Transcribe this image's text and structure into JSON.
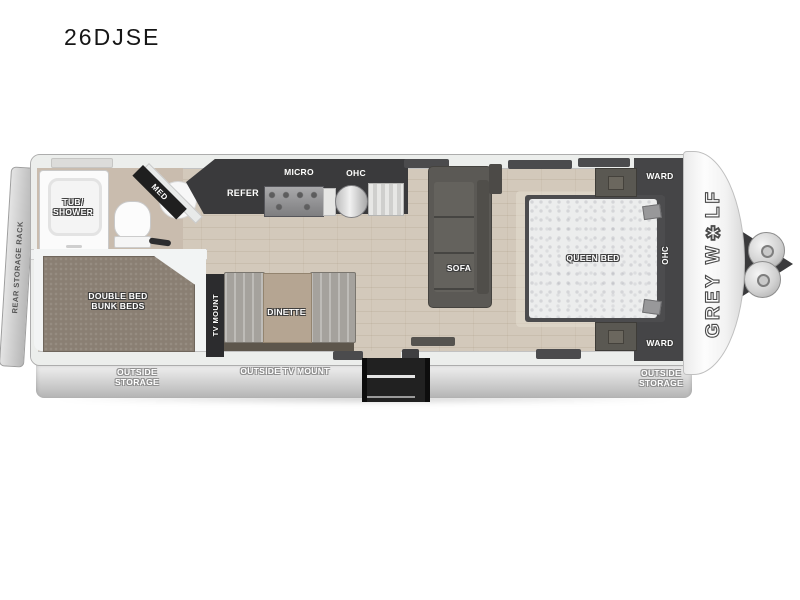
{
  "title": "26DJSE",
  "brand_logo": "GREY W✱LF",
  "exterior_labels": {
    "rear_storage_rack": "REAR STORAGE RACK",
    "outside_storage_left_line1": "OUTSIDE",
    "outside_storage_left_line2": "STORAGE",
    "outside_tv_mount": "OUTSIDE TV MOUNT",
    "outside_storage_right_line1": "OUTSIDE",
    "outside_storage_right_line2": "STORAGE"
  },
  "bathroom": {
    "tub_line1": "TUB/",
    "tub_line2": "SHOWER",
    "med": "MED"
  },
  "kitchen": {
    "refer": "REFER",
    "micro": "MICRO",
    "ohc": "OHC"
  },
  "living": {
    "sofa": "SOFA",
    "dinette": "DINETTE",
    "tv_mount": "TV MOUNT"
  },
  "bunk_room": {
    "line1": "DOUBLE BED",
    "line2": "BUNK BEDS"
  },
  "bedroom": {
    "queen_bed": "QUEEN BED",
    "ward_top": "WARD",
    "ward_bottom": "WARD",
    "ohc": "OHC"
  }
}
